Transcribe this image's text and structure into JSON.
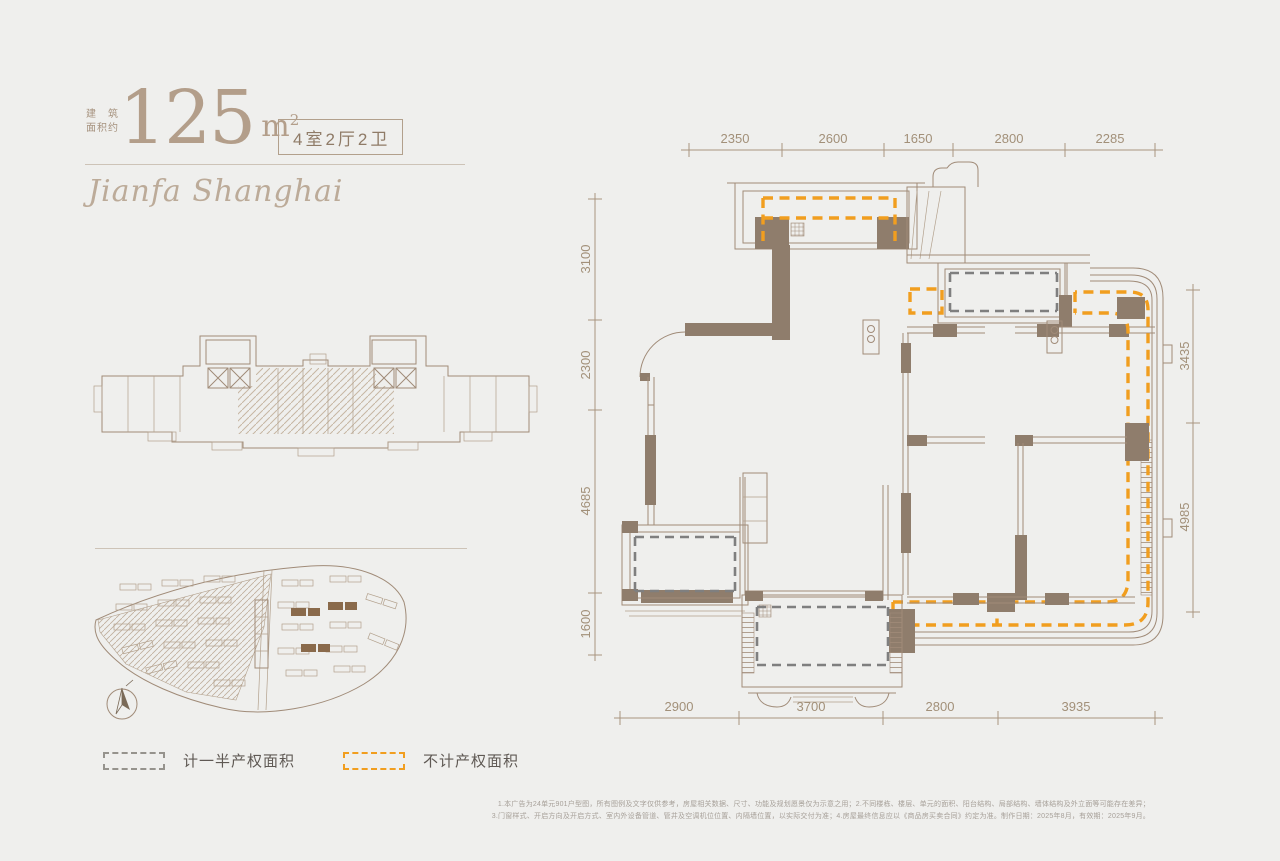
{
  "header": {
    "area_label_line1": "建　筑",
    "area_label_line2": "面积约",
    "area_value": "125",
    "area_unit_base": "m",
    "area_unit_sup": "2",
    "room_tag": "4室2厅2卫",
    "brand_script": "Jianfa Shanghai"
  },
  "legend": {
    "half_property_label": "计一半产权面积",
    "excluded_label": "不计产权面积"
  },
  "dimensions": {
    "top": [
      "2350",
      "2600",
      "1650",
      "2800",
      "2285"
    ],
    "left": [
      "3100",
      "2300",
      "4685",
      "1600"
    ],
    "right": [
      "3435",
      "4985"
    ],
    "bottom": [
      "2900",
      "3700",
      "2800",
      "3935"
    ]
  },
  "footnotes": {
    "line1": "1.本广告为24单元901户型图，所有图例及文字仅供参考，房屋相关数据、尺寸、功能及规划愿景仅为示意之用；2.不同楼栋、楼层、单元的面积、阳台结构、局部结构、墙体结构及外立面等可能存在差异；",
    "line2": "3.门窗样式、开启方向及开启方式、室内外设备管道、管井及空调机位位置、内隔墙位置，以实际交付为准；4.房屋最终信息应以《商品房买卖合同》约定为准。制作日期：2025年8月，有效期：2025年9月。"
  },
  "colors": {
    "background": "#EFEFED",
    "line": "#a08b78",
    "wall": "#8f7d6c",
    "orange_dash": "#f19e1f",
    "gray_dash": "#7f7f7f",
    "highlight": "#8a6a4b"
  }
}
